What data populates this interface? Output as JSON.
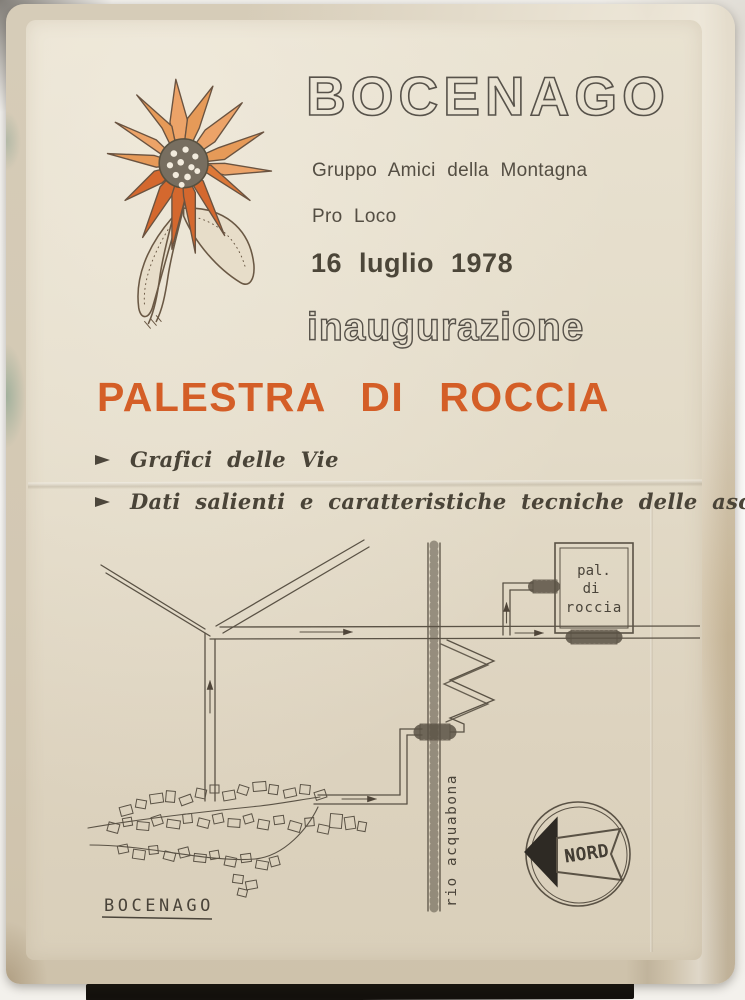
{
  "poster": {
    "title": "BOCENAGO",
    "org_line1": "Gruppo Amici della Montagna",
    "org_line2": "Pro Loco",
    "date": "16 luglio 1978",
    "event": "inaugurazione",
    "headline": "PALESTRA DI ROCCIA",
    "bullets": [
      {
        "label": "Grafici delle Vie"
      },
      {
        "label": "Dati salienti e caratteristiche tecniche delle ascensioni"
      }
    ],
    "map": {
      "building_label_lines": [
        "pal.",
        "di",
        "roccia"
      ],
      "river_label": "rio acquabona",
      "village_label": "BOCENAGO",
      "compass_label": "NORD"
    },
    "icons": {
      "bullet_arrow": "right-triangle-arrow",
      "compass": "north-arrow"
    },
    "colors": {
      "accent_orange": "#d45e27",
      "ink": "#4c4639",
      "paper": "#e3dbc8"
    }
  }
}
